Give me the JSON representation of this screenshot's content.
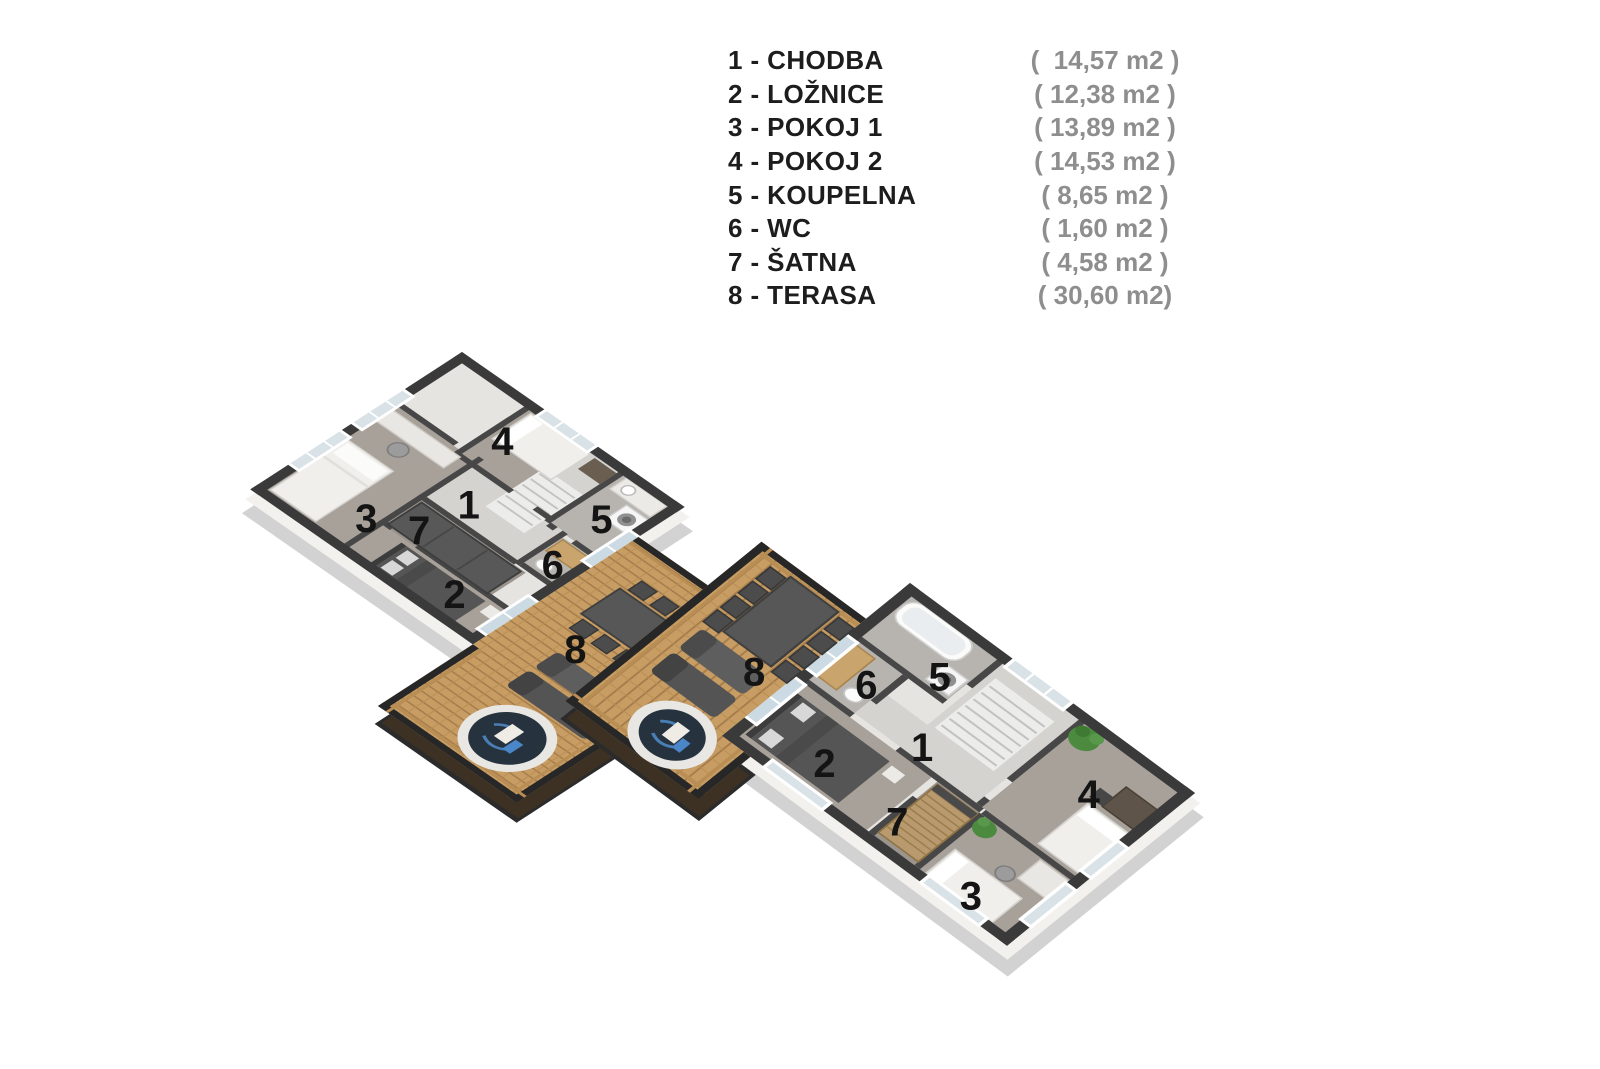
{
  "legend": {
    "items": [
      {
        "label": "1 - CHODBA",
        "area": "(  14,57 m2 )"
      },
      {
        "label": "2 - LOŽNICE",
        "area": "( 12,38 m2 )"
      },
      {
        "label": "3 - POKOJ 1",
        "area": "( 13,89 m2 )"
      },
      {
        "label": "4 - POKOJ 2",
        "area": "( 14,53 m2 )"
      },
      {
        "label": "5 - KOUPELNA",
        "area": "( 8,65 m2 )"
      },
      {
        "label": "6 - WC",
        "area": "( 1,60 m2 )"
      },
      {
        "label": "7 - ŠATNA",
        "area": "( 4,58 m2 )"
      },
      {
        "label": "8 - TERASA",
        "area": "( 30,60 m2)"
      }
    ]
  },
  "floorplan": {
    "units": [
      {
        "id": "left",
        "labels": [
          {
            "n": "1",
            "u": 139,
            "v": 131
          },
          {
            "n": "2",
            "u": 210,
            "v": 219
          },
          {
            "n": "3",
            "u": 92,
            "v": 206
          },
          {
            "n": "4",
            "u": 102,
            "v": 54
          },
          {
            "n": "5",
            "u": 228,
            "v": 62
          },
          {
            "n": "6",
            "u": 240,
            "v": 132
          },
          {
            "n": "7",
            "u": 133,
            "v": 184
          },
          {
            "n": "8",
            "u": 328,
            "v": 193
          }
        ]
      },
      {
        "id": "right",
        "labels": [
          {
            "n": "1",
            "u": 118,
            "v": 125
          },
          {
            "n": "2",
            "u": 75,
            "v": 196
          },
          {
            "n": "3",
            "u": 246,
            "v": 216
          },
          {
            "n": "4",
            "u": 242,
            "v": 64
          },
          {
            "n": "5",
            "u": 80,
            "v": 58
          },
          {
            "n": "6",
            "u": 45,
            "v": 108
          },
          {
            "n": "7",
            "u": 155,
            "v": 200
          },
          {
            "n": "8",
            "u": -26,
            "v": 164
          }
        ]
      }
    ],
    "colors": {
      "wall_dark": "#3a3a3a",
      "wall_inner": "#474747",
      "floor_room": "#a8a19a",
      "floor_hall": "#d5d3cf",
      "floor_bath": "#b7b4b0",
      "deck_wood": "#c79d63",
      "deck_seam": "#a57c4b",
      "railing": "#272727",
      "railing_wood": "#b98e55",
      "hot_tub_water": "#26333f",
      "accent_blue": "#4a86c8",
      "plant_green": "#4c8b3f",
      "legend_text": "#1d1d1d",
      "legend_area": "#8e8e8e"
    }
  }
}
